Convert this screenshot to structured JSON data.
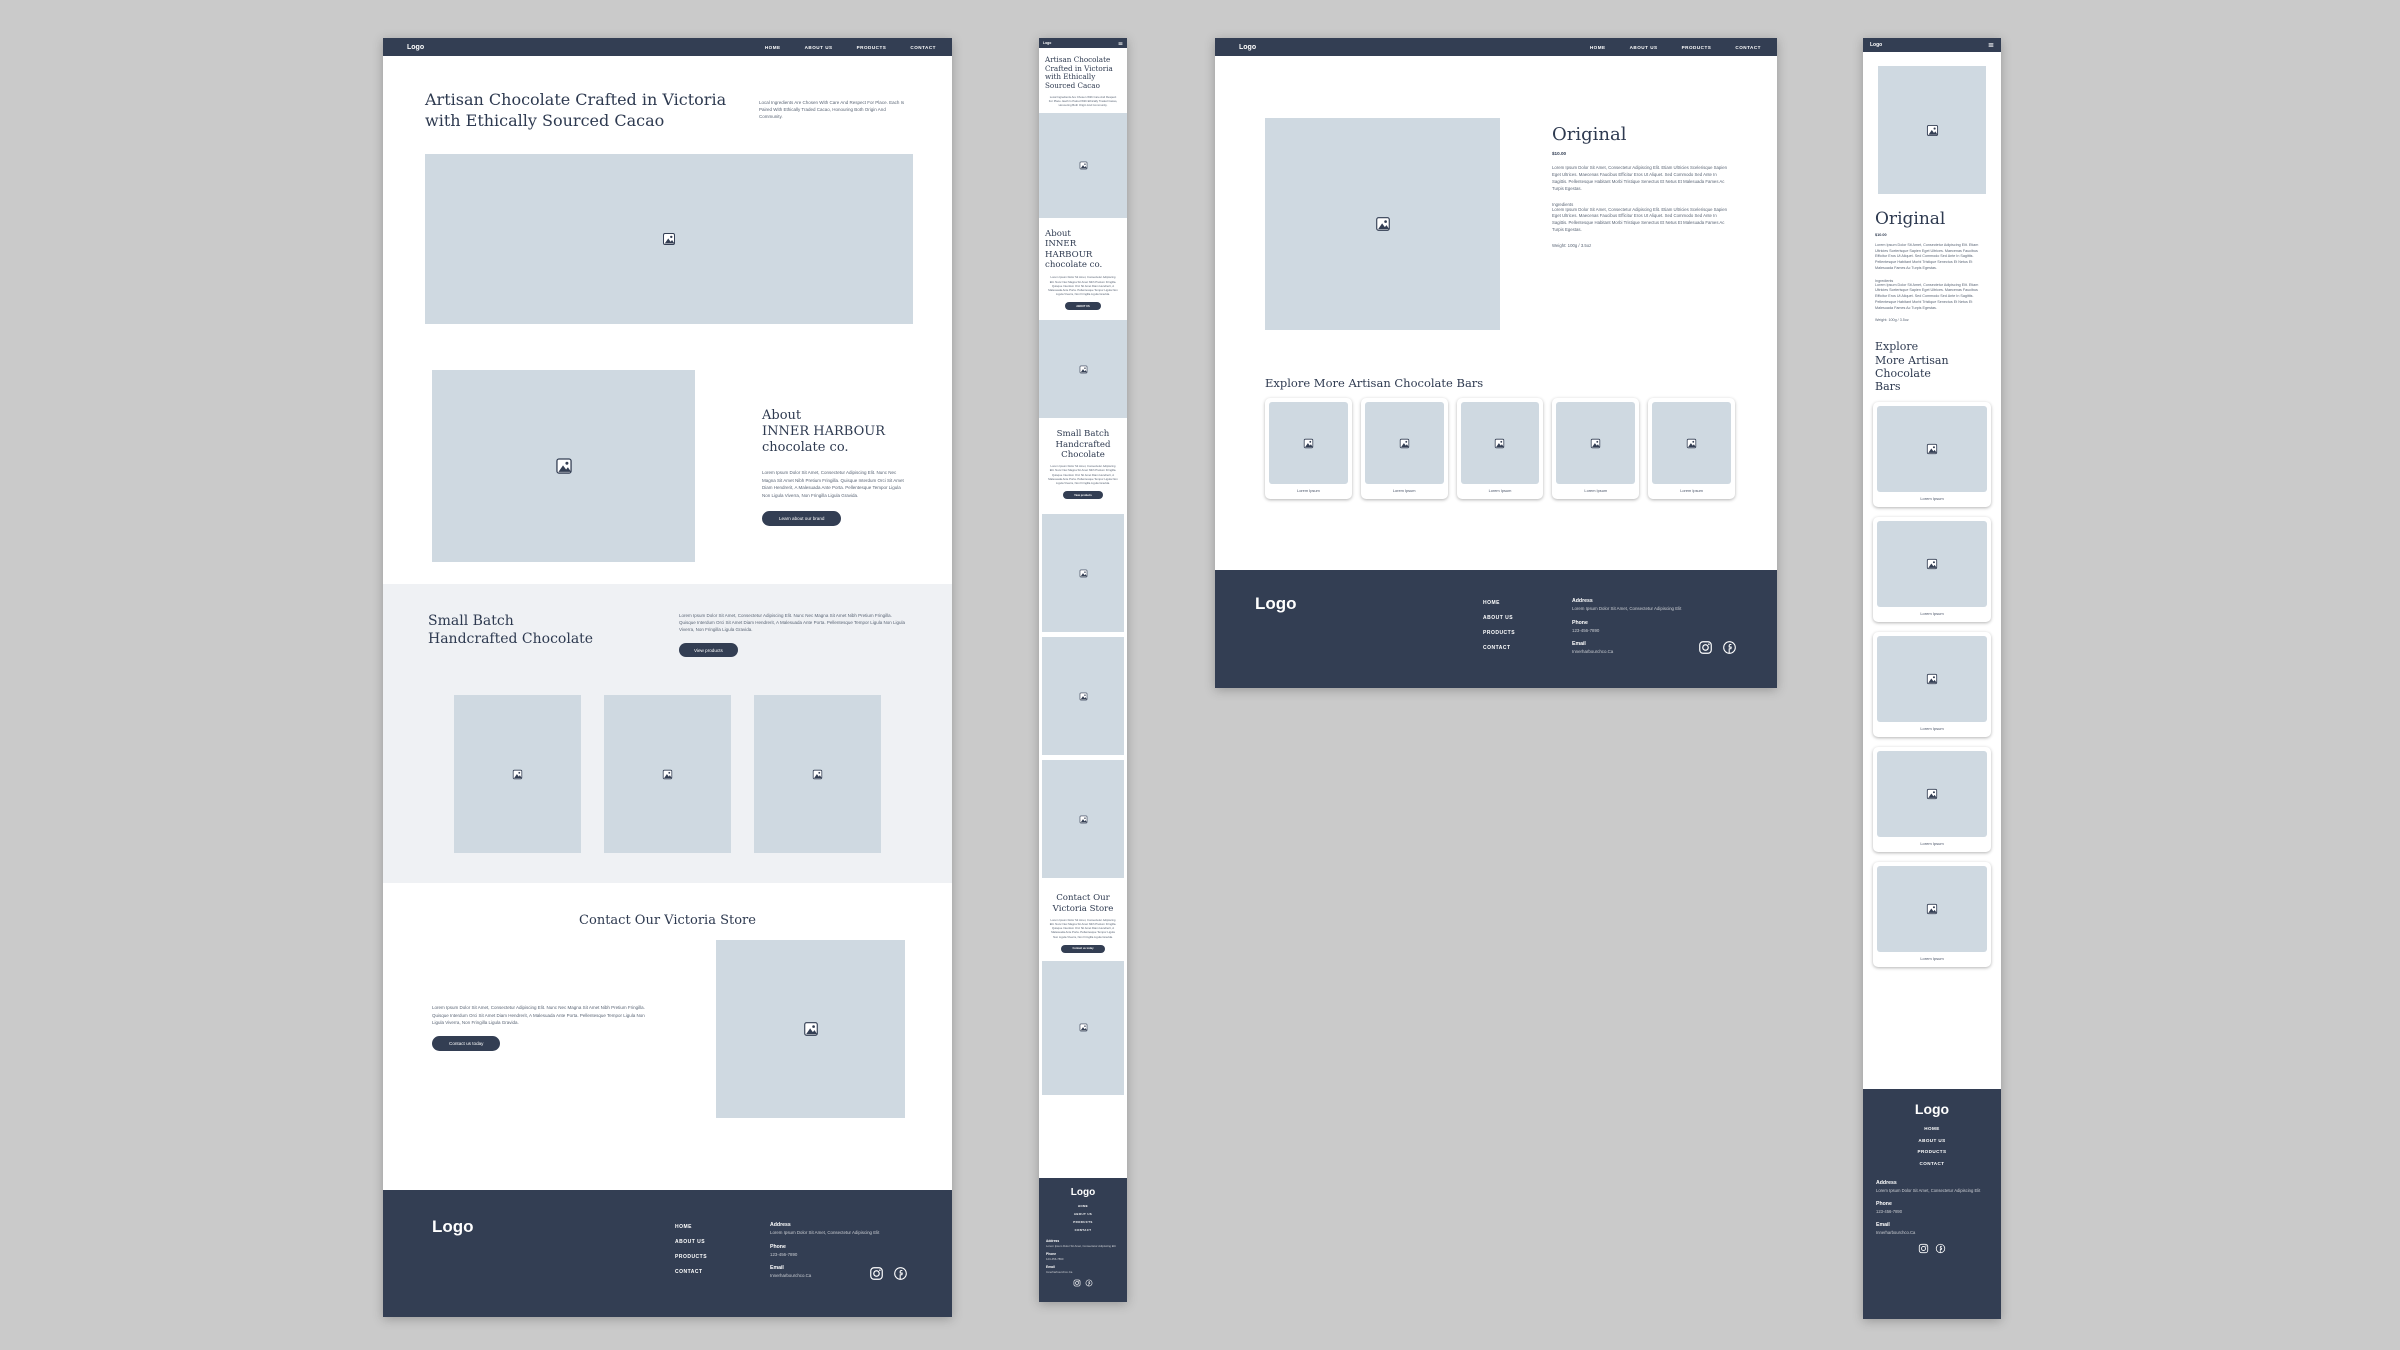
{
  "colors": {
    "navy": "#333E53",
    "placeholder": "#CFD9E1",
    "section_light": "#EFF1F4",
    "canvas": "#CACACA"
  },
  "nav": {
    "logo": "Logo",
    "items": [
      "HOME",
      "ABOUT US",
      "PRODUCTS",
      "CONTACT"
    ]
  },
  "home": {
    "hero": {
      "title": "Artisan Chocolate Crafted in Victoria with Ethically Sourced Cacao",
      "blurb": "Local Ingredients Are Chosen With Care And Respect For Place. Each Is Paired With Ethically Traded Cacao, Honouring Both Origin And Community."
    },
    "about": {
      "pre": "About",
      "brand": "INNER HARBOUR",
      "suffix": "chocolate co.",
      "body": "Lorem Ipsum Dolor Sit Amet, Consectetur Adipiscing Elit. Nunc Nec Magna Sit Amet Nibh Pretium Fringilla. Quisque Interdum Orci Sit Amet Diam Hendrerit, A Malesuada Ante Porta. Pellentesque Tempor Ligula Non Ligula Viverra, Non Fringilla Ligula Gravida.",
      "cta_desktop": "Learn about our brand",
      "cta_mobile": "ABOUT US"
    },
    "products": {
      "line1": "Small Batch",
      "line2": "Handcrafted Chocolate",
      "body": "Lorem Ipsum Dolor Sit Amet, Consectetur Adipiscing Elit. Nunc Nec Magna Sit Amet Nibh Pretium Fringilla. Quisque Interdum Orci Sit Amet Diam Hendrerit, A Malesuada Ante Porta. Pellentesque Tempor Ligula Non Ligula Viverra, Non Fringilla Ligula Gravida.",
      "cta": "View products"
    },
    "contact": {
      "title": "Contact Our Victoria Store",
      "body": "Lorem Ipsum Dolor Sit Amet, Consectetur Adipiscing Elit. Nunc Nec Magna Sit Amet Nibh Pretium Fringilla. Quisque Interdum Orci Sit Amet Diam Hendrerit, A Malesuada Ante Porta. Pellentesque Tempor Ligula Non Ligula Viverra, Non Fringilla Ligula Gravida.",
      "cta": "Contact us today"
    }
  },
  "product": {
    "name": "Original",
    "price": "$10.00",
    "description": "Lorem Ipsum Dolor Sit Amet, Consectetur Adipiscing Elit. Etiam Ultricies Scelerisque Sapien Eget Ultrices. Maecenas Faucibus Efficitur Eros Ut Aliquet. Sed Commodo Sed Ante In Sagittis. Pellentesque Habitant Morbi Tristique Senectus Et Netus Et Malesuada Fames Ac Turpis Egestas.",
    "ingredients_label": "Ingredients",
    "ingredients": "Lorem Ipsum Dolor Sit Amet, Consectetur Adipiscing Elit. Etiam Ultricies Scelerisque Sapien Eget Ultrices. Maecenas Faucibus Efficitur Eros Ut Aliquet. Sed Commodo Sed Ante In Sagittis. Pellentesque Habitant Morbi Tristique Senectus Et Netus Et Malesuada Fames Ac Turpis Egestas.",
    "weight": "Weight: 100g / 3.5oz",
    "explore_title": "Explore More Artisan Chocolate Bars",
    "explore_title_line1": "Explore",
    "explore_title_line2": "More Artisan Chocolate Bars",
    "card_label": "Lorem Ipsum"
  },
  "footer": {
    "logo": "Logo",
    "links": [
      "HOME",
      "ABOUT US",
      "PRODUCTS",
      "CONTACT"
    ],
    "address_label": "Address",
    "address": "Lorem Ipsum Dolor Sit Amet, Consectetur Adipiscing Elit",
    "phone_label": "Phone",
    "phone": "123-456-7890",
    "email_label": "Email",
    "email": "Innerharbourchco.Ca"
  }
}
